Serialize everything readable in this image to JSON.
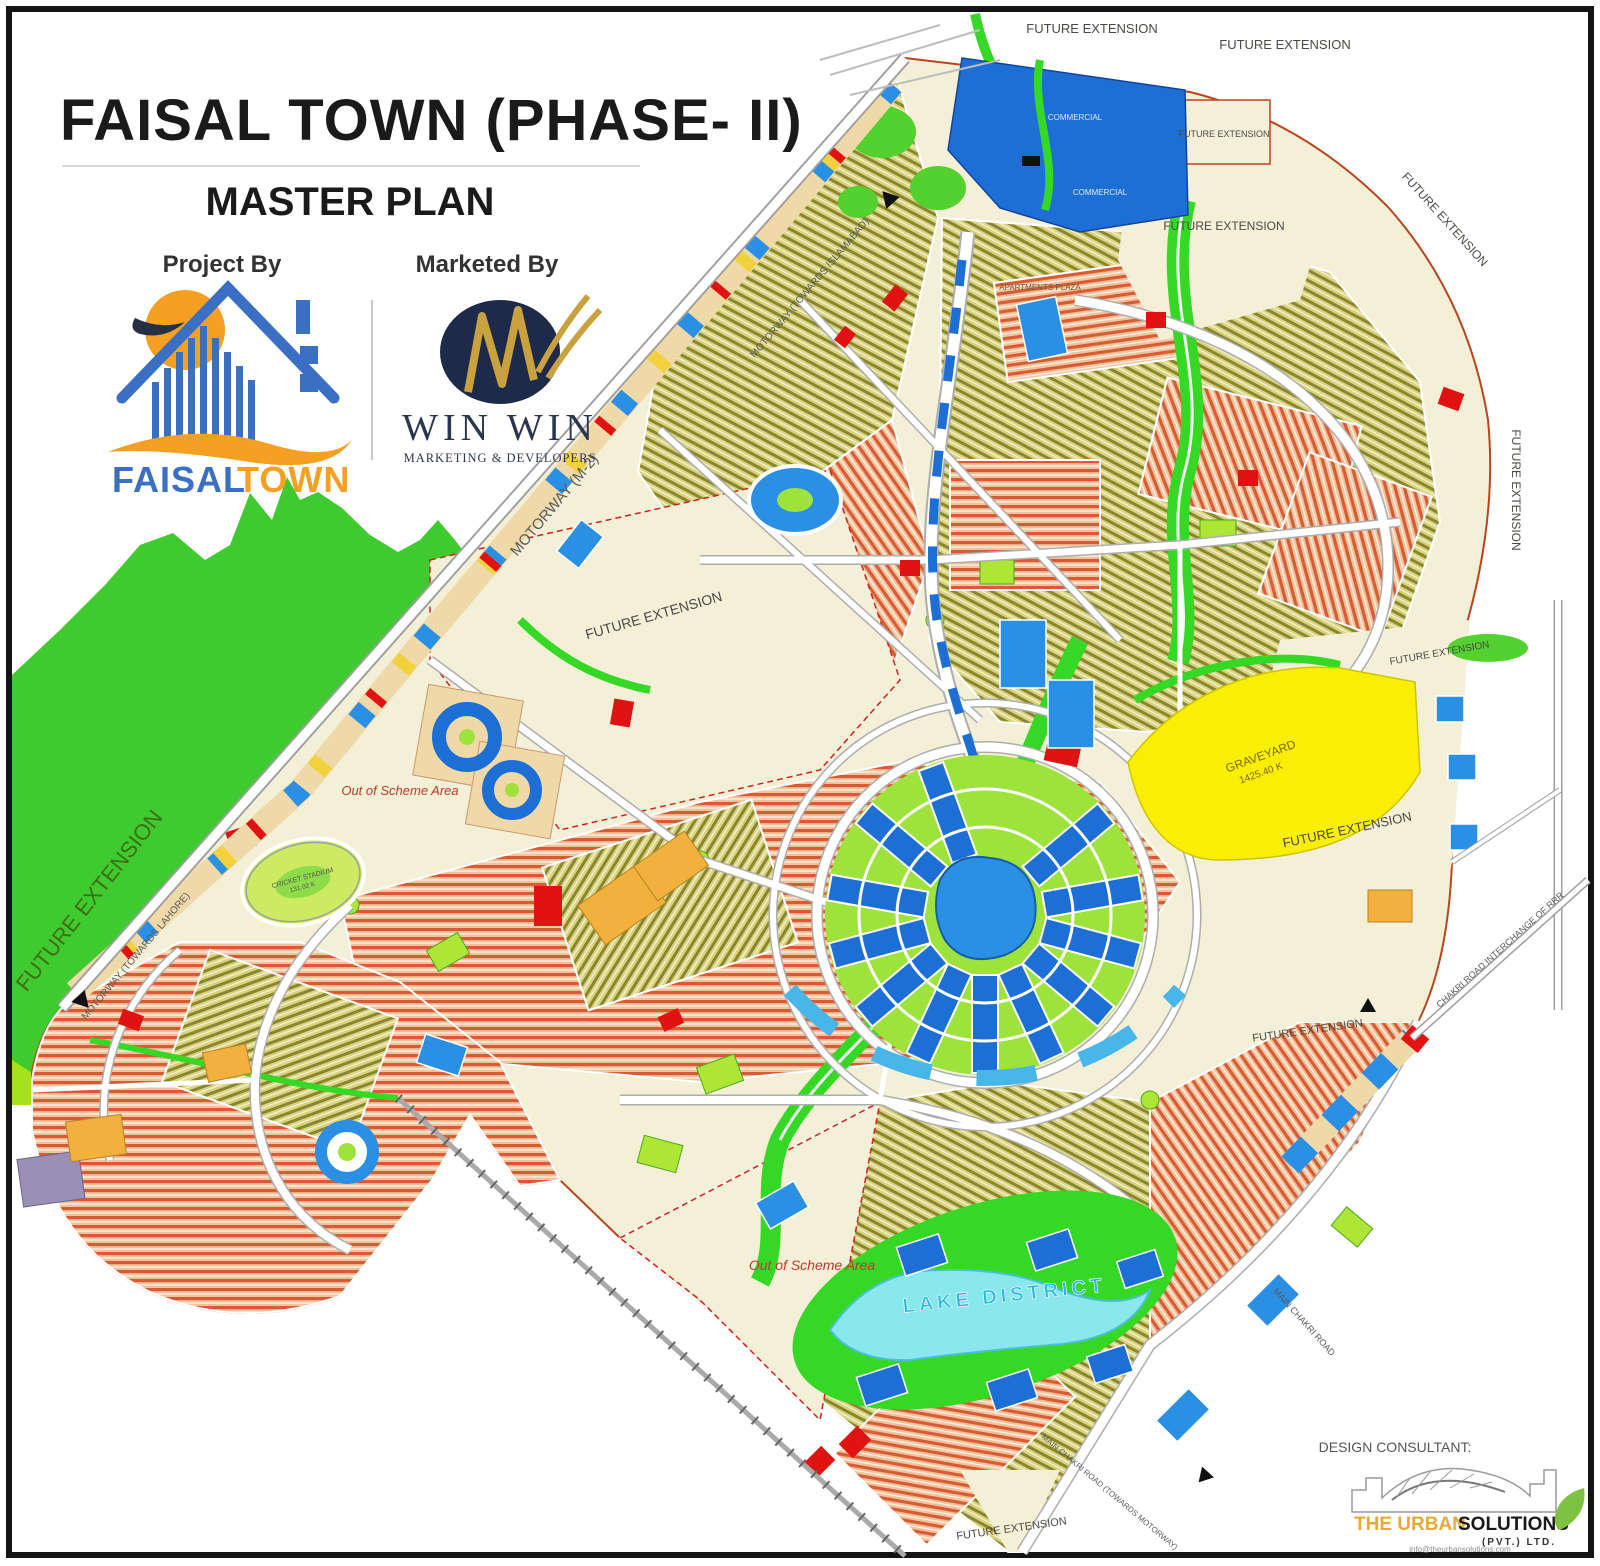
{
  "title": {
    "main": "FAISAL TOWN (PHASE- II)",
    "sub": "MASTER PLAN"
  },
  "credits": {
    "project_by": "Project By",
    "marketed_by": "Marketed By",
    "faisal_logo_word1": "FAISAL",
    "faisal_logo_word2": "TOWN",
    "winwin_name": "WIN WIN",
    "winwin_tagline": "MARKETING & DEVELOPERS"
  },
  "map_labels": {
    "future_extension": "FUTURE EXTENSION",
    "out_of_scheme": "Out of Scheme Area",
    "motorway_m2": "MOTORWAY (M-2)",
    "motorway_islamabad": "MOTORWAY (TOWARDS ISLAMABAD)",
    "motorway_lahore": "MOTORWAY (TOWARDS LAHORE)",
    "graveyard": "GRAVEYARD",
    "graveyard_area": "1425.40 K",
    "cricket_stadium": "CRICKET STADIUM",
    "cricket_area": "131.02 K",
    "lake_district": "LAKE DISTRICT",
    "apartments_plaza": "APARTMENTS PLAZA",
    "commercial": "COMMERCIAL",
    "main_chakri_road": "MAIN CHAKRI ROAD",
    "chakri_interchange": "CHAKRI ROAD INTERCHANGE OF RRR",
    "main_chakri_towards": "MAIN CHAKRI ROAD (TOWARDS MOTORWAY)"
  },
  "footer": {
    "design_consultant": "DESIGN CONSULTANT:",
    "consultant_name_1": "THE URBAN",
    "consultant_name_2": "SOLUTIONS",
    "consultant_suffix": "(PVT.) LTD.",
    "consultant_email": "info@theurbansolutions.com"
  },
  "colors": {
    "hill_green": "#3fca2f",
    "lime_band": "#a6e21c",
    "map_cream": "#f4efd7",
    "plot_salmon": "#d95b35",
    "plot_olive": "#8a8630",
    "commercial_blue": "#1d6fd6",
    "park_green": "#35d824",
    "lake_cyan": "#8ae8ec",
    "graveyard_yellow": "#f8ef04",
    "accent_red": "#e01212",
    "faisal_blue": "#3a6fc4",
    "faisal_orange": "#f59f23",
    "winwin_navy": "#1d2a4a",
    "winwin_gold": "#c9a23f",
    "urban_orange": "#e8a93c"
  }
}
